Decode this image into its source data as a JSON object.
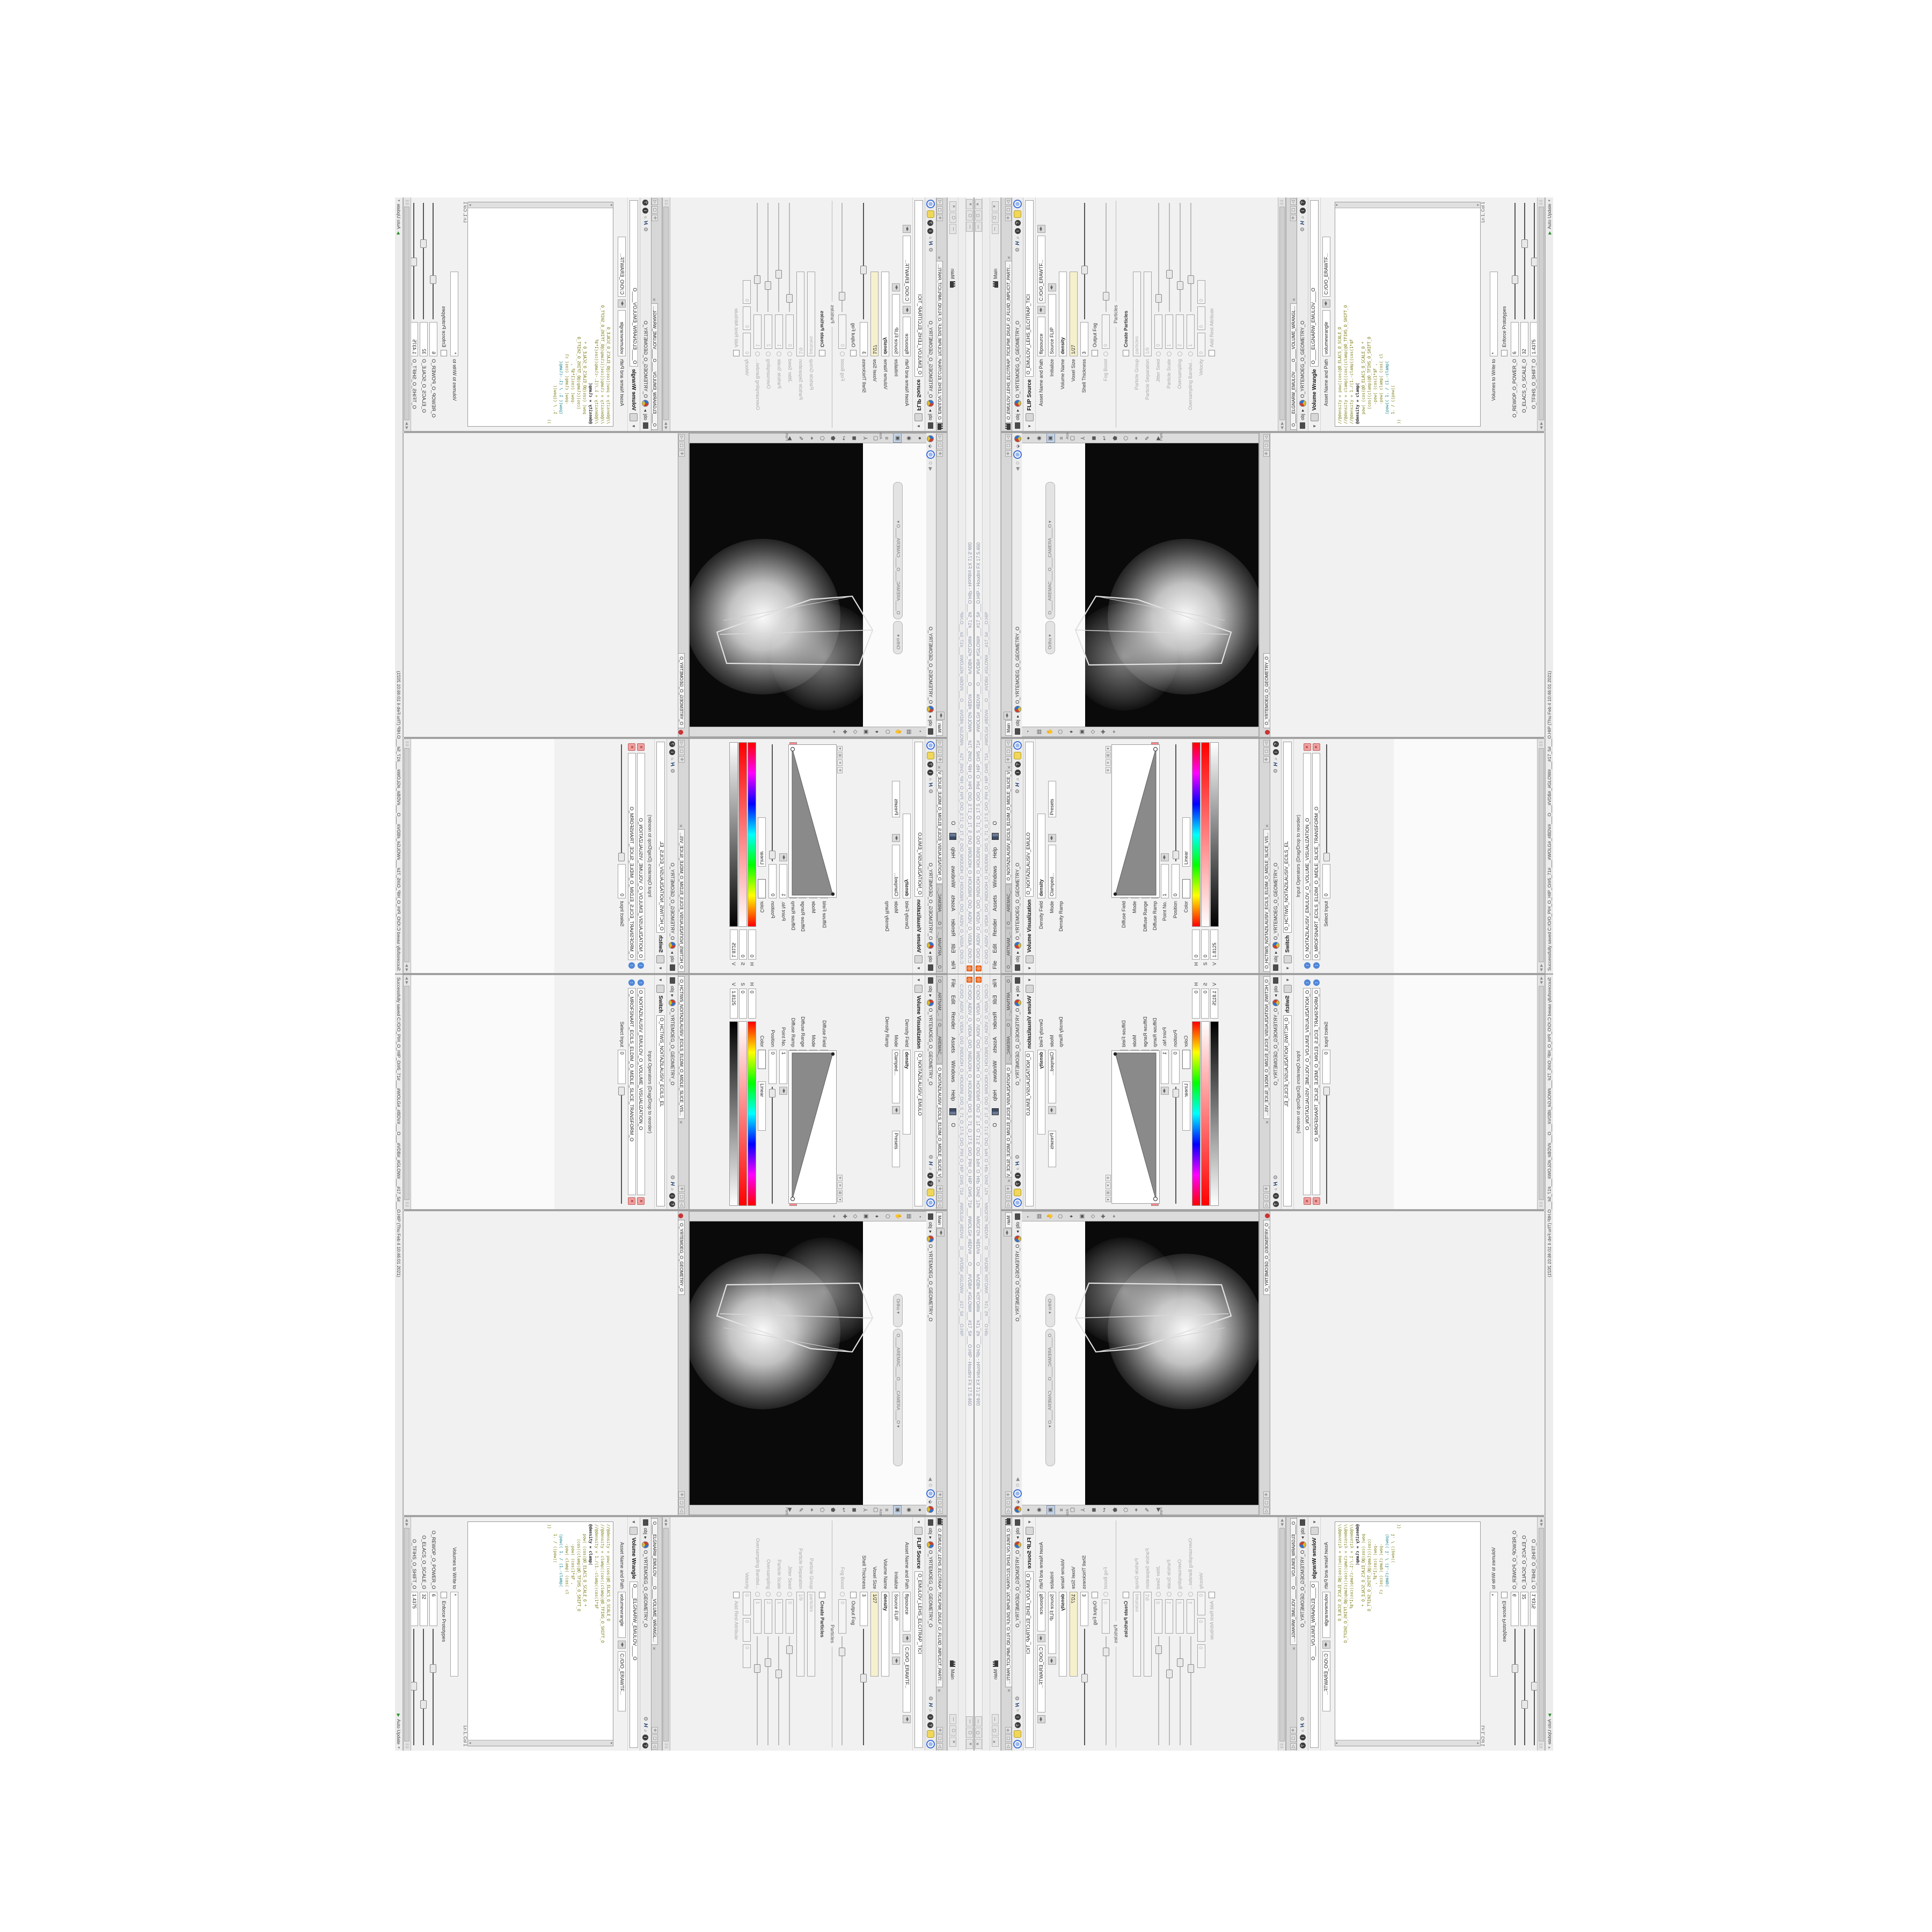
{
  "window": {
    "title": "C:/O/O_AIDIV_O_VIDIA_O/O_INIDUOH_O_HOUDINI_O/O_5_71_O_17.5_O/O_PIH_O_HIP_O/#5_71#___#WOLG#_#BDV#___O___#VDB#_#GLOW#___#17_5#___O.HIP - Houdini FX 17.5.460",
    "address": "C:/O/O_AIDIV_O_VIDIA_O/O_INIDUOH_O_HOUDINI_O/O_5_71_O_17.5_O/O_PIH_O_HIP_O/#5_71#___#WOLG#_#BDV#___O___#VDB#_#GLOW#___#17_5#___O.HIP",
    "app_icon": "houdini-spiral-logo",
    "buttons": [
      "—",
      "▢",
      "✕"
    ]
  },
  "menu": {
    "items": [
      "File",
      "Edit",
      "Render",
      "Assets",
      "Windows",
      "Help"
    ],
    "after_icon_label": "O",
    "desktop_label": "Main"
  },
  "breadcrumb": {
    "root": "obj",
    "node": "O_YRTEMOEG_O_GEOMETRY_O"
  },
  "tabs": {
    "left": [
      "O____ARTNAM_...",
      "O____AREMAC_...",
      "O_NOITAZILAUSIV_ECILS_ELDIM_O_MIDLE_SLICE_VISUAL..."
    ],
    "viewport": "Main",
    "network": "O_YRTEMOEG_O_GEOMETRY_O",
    "flip": "O_EMULOV_LEHS_ELCITRAP_TICILPMI_DIULF_O_FLUID_IMPLICIT_PARTI...",
    "switch": "O_HCTIWS_NOITAZILAUSIV_ECILS_ELDIM_O_MIDLE_SLICE_VIS...",
    "wrangle": "O____ELGNARW_EMULOV____O____VOLUME_WRANGL..."
  },
  "visualization": {
    "title": "Volume Visualization",
    "name": "O_NOITAZILAUSIV_EMULO",
    "density_field_label": "Density Field",
    "density_field": "density",
    "mode_label": "Mode",
    "mode": "Clamped...",
    "presets": "Presets",
    "density_ramp_label": "Density Ramp",
    "diffuse_field_label": "Diffuse Field",
    "diffuse_field": "density",
    "mode2": "Clamped R...",
    "presets2": "Presets",
    "diffuse_range_label": "Diffuse Range",
    "range_min": "0",
    "range_max": "1",
    "diffuse_ramp_label": "Diffuse Ramp",
    "point_no_label": "Point No.",
    "point_no": "1",
    "position_label": "Position",
    "position": "0",
    "color_label": "Color",
    "interp_label": "Interpolation",
    "interp": "Linear",
    "h_label": "H",
    "h": "0",
    "s_label": "S",
    "s": "0",
    "v_label": "V",
    "v": "1.8125"
  },
  "switch": {
    "title": "Switch",
    "name": "O_HCTIWS_NOITAZILAUSIV_ECILS_EL",
    "inputs_label": "Input Operators (Drag/Drop to reorder)",
    "inputs": [
      "O_NOITAZILAUSIV_EMULOV_O_VOLUME_VISUALIZATION_O",
      "O_MROFSNART_ECILS_ELDIM_O_MIDLE_SLICE_TRANSFORM_O"
    ],
    "select_input_label": "Select Input",
    "select_input": "0"
  },
  "viewport": {
    "pills": [
      "Ortho",
      "O____AREMAC____O____CAMERA____O"
    ],
    "side_labels": [
      "Asset",
      "Parti..."
    ],
    "left_tools": [
      "◔",
      "▤",
      "✋",
      "⬡",
      "♦",
      "▣",
      "◇",
      "✚",
      "⌖"
    ],
    "right_tools": [
      "●",
      "◉",
      "▣",
      "≡",
      "▢",
      "⅄",
      "◼",
      "↩",
      "⬟",
      "⬠",
      "⚭",
      "✎",
      "▶"
    ]
  },
  "network": {
    "watermark": "Geometry",
    "nodes": [
      {
        "type": "an_CubeSphere",
        "name": "O_EREHPS_EBUC_O_CUBE_SPHERE_O",
        "color": "#3aa655"
      },
      {
        "type": "BodyWire",
        "name": "O_EMARFERIW_NOGYLOP_EREHPS_EBUC_O_CUBE_SPHERE_POLYGON_WIREFRAME_O",
        "color": "#8f8f8f"
      },
      {
        "type": "File",
        "name": "O_JBO_MD3_PETS_O_STEP_3DM_OBJ_O",
        "color": "#c9a063",
        "blue": true
      },
      {
        "type": "Switch",
        "name": "O_HCTIWS_YRTEMOEG_LANRETXE_LANRETNI_O_INTERNAL_EXTERNAL_GEOMETRY_SWITCH_O",
        "color": "#8f8f8f"
      },
      {
        "type": "Clip",
        "name": "O_PILC_REDROB_O_BORDER_CLIP_O",
        "color": "#bdbdbd"
      },
      {
        "type": "Clip",
        "name": "O_PILC_PETS_TSRIF_O_FIRST_STEP_CLIP_O",
        "color": "#bdbdbd"
      },
      {
        "type": "FLIP Source",
        "name": "O_EMULOV_LEHS_ELCITRAP_TICILPMI_DIULF_O_FLUID_IMPLICIT_PARTICLE_SHEL_VOLUME_O",
        "color": "#e08030",
        "flagL": true
      },
      {
        "type": "VDB from Polygons",
        "name": "O_SNOGYLOP_YRTEMOEG_MORF_EMULOV_BDV_O_VDB_VOLUME_FROM_GEOMETRY_POLYGONS_O",
        "color": "#7a93b5",
        "flagL": true
      },
      {
        "type": "Volume Wrangle",
        "name": "O____ELGNARW_EMULOV____O____VOLUME_WRANGLE____O2",
        "color": "#a9a94f",
        "flagL": true
      },
      {
        "type": "Volume Visualize",
        "name": "O_NOITAZILAUSIV_EMULOV_O_VOLUME_VISUALIZATION_O",
        "color": "#9a7fc4",
        "flagL": true
      },
      {
        "type": "Transform",
        "name": "O_MROFSNART_ECILS_ELDIM_O_MIDLE_SLICE_TRANSFORM_O",
        "color": "#8f8f8f",
        "flagR": true
      },
      {
        "type": "Switch",
        "name": "O_HCTIWS_NOITAZILAUSIV_ECILS_ELDIM_O_MIDLE_SLICE_VISUALIZATION_SWITCH_O",
        "color": "#8f8f8f",
        "flagL": true
      }
    ],
    "selected_node": {
      "type": "Transform",
      "name": "O_MROFSNART_TLUSER_O_RESULT_TRANSFORM_O",
      "color": "#a98fd6"
    }
  },
  "flip": {
    "title": "FLIP Source",
    "name": "O_EMULOV_LEHS_ELCITRAP_TICI",
    "rows": [
      {
        "label": "Asset Name and Path",
        "fields": [
          {
            "v": "flipsource",
            "w": 66,
            "spin": 1
          },
          {
            "v": "C:/O/O_ERAWTF...",
            "w": 118,
            "spin": 1
          }
        ]
      },
      {
        "label": "Initialize",
        "fields": [
          {
            "v": "Source FLIP",
            "w": 108,
            "spin": 1
          }
        ]
      },
      {
        "label": "Volume Name",
        "fields": [
          {
            "v": "density",
            "w": 150,
            "cls": "bold"
          }
        ]
      },
      {
        "label": "Voxel Size",
        "fields": [
          {
            "v": "1/27",
            "w": 150,
            "cls": "expr"
          }
        ]
      },
      {
        "label": "Shell Thickness",
        "fields": [
          {
            "v": "3",
            "w": 56
          }
        ],
        "slider": 0.38
      },
      {
        "checkbox": {
          "label": "Output Fog",
          "checked": false
        }
      },
      {
        "label": "Fog Boost",
        "dis": 1,
        "fields": [
          {
            "v": "0",
            "w": 56
          }
        ],
        "slider": 0.1,
        "rev": 1
      },
      {
        "section": "Particles"
      },
      {
        "checkbox": {
          "label": "Create Particles",
          "checked": false,
          "bold": 1
        }
      },
      {
        "label": "Particle Group",
        "dis": 1,
        "fields": [
          {
            "v": "particles",
            "w": 150
          }
        ]
      },
      {
        "label": "Particle Separation",
        "dis": 1,
        "fields": [
          {
            "v": "1/9",
            "w": 150
          }
        ]
      },
      {
        "label": "Jitter Seed",
        "dis": 1,
        "fields": [
          {
            "v": "0",
            "w": 56
          }
        ],
        "slider": 0.08,
        "rev": 1
      },
      {
        "label": "Particle Scale",
        "dis": 1,
        "fields": [
          {
            "v": "1",
            "w": 56
          }
        ],
        "slider": 0.3,
        "rev": 1
      },
      {
        "label": "Oversampling",
        "dis": 1,
        "fields": [
          {
            "v": "2",
            "w": 56
          }
        ],
        "slider": 0.2,
        "rev": 1
      },
      {
        "label": "Oversampling Bandwi...",
        "dis": 1,
        "fields": [
          {
            "v": "1",
            "w": 56
          }
        ],
        "slider": 0.25,
        "rev": 1
      },
      {
        "label": "Velocity",
        "dis": 1,
        "fields": [
          {
            "v": "0",
            "w": 36
          },
          {
            "v": "0",
            "w": 36
          },
          {
            "v": "0",
            "w": 36
          }
        ]
      },
      {
        "checkbox": {
          "label": "Add Rest Attribute",
          "checked": false,
          "dis": 1
        }
      }
    ]
  },
  "wrangle": {
    "title": "Volume Wrangle",
    "name": "O____ELGNARW_EMULOV____O",
    "asset_label": "Asset Name and Path",
    "asset_name": "volumewrangle",
    "asset_path": "C:/O/O_ERAWTF...",
    "code": [
      {
        "t": "//@density = pow((cos(@O_ELACS_O_SCALE_O",
        "c": "olive"
      },
      {
        "t": "//@density = clamp((cos((clamp(@O_TFIHS_O_SHIFT_O",
        "c": "olive"
      },
      {
        "t": "//@density = 1./(1.-clamp((cos(1*$F",
        "c": "olive"
      },
      {
        "t": "@density = clamp(",
        "c": "dark"
      },
      {
        "t": "    pow( (cos(@O_ELACS_O_SCALE_O *",
        "c": "olive"
      },
      {
        "t": "      (cos((clamp(@O_TFIHS_O_SHIFT_O",
        "c": "olive"
      },
      {
        "t": "        -pow( (cos(1*$F ,",
        "c": "olive"
      },
      {
        "t": "        -pow( clamp( (cos( cl",
        "c": "olive"
      },
      {
        "t": "    (pow(( 1. / (1.-clamp(",
        "c": "teal"
      },
      {
        "t": "    1. / ((pow((",
        "c": "olive"
      },
      {
        "t": "))",
        "c": "olive"
      }
    ],
    "lncol": "Ln 1, Col 1",
    "volumes_label": "Volumes to Write to",
    "volumes": "*",
    "enforce_label": "Enforce Prototypes",
    "spare": [
      {
        "label": "O_REWOP_O_POWER_O",
        "v": "6",
        "slider": 0.3
      },
      {
        "label": "O_ELACS_O_SCALE_O",
        "v": "32",
        "slider": 0.6
      },
      {
        "label": "O_TFIHS_O_SHIFT_O",
        "v": "1.4375",
        "slider": 0.45
      }
    ]
  },
  "status": {
    "message": "Successfully saved C:/O/O_PIH_O_HIP_O/#5_71#___#WOLG#_#BDV#___O___#VDB#_#GLOW#___#17_5#___O.HIP (Thu Feb 4 10:46:01 2021)",
    "update_mode": "Auto Update"
  }
}
